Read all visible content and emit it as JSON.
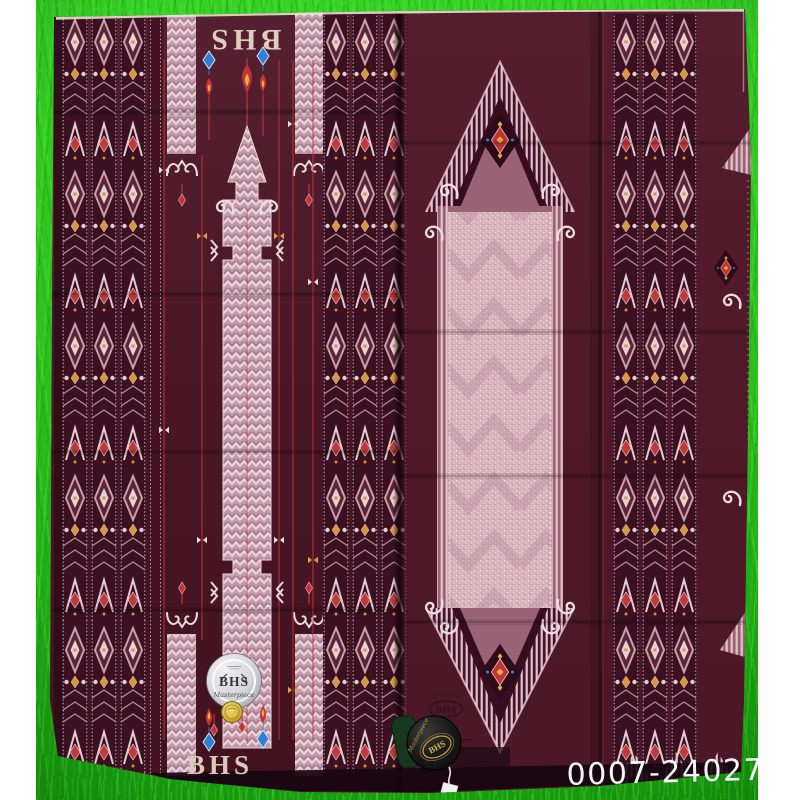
{
  "scene": {
    "watermark": "0007-240271",
    "colors": {
      "background_green": "#2cc01d",
      "margin_white": "#ffffff",
      "fabric_maroon": "#4a1626",
      "pattern_pink": "#c49bab",
      "pattern_light_pink": "#d8b2bd",
      "accent_gold": "#d79043",
      "accent_red": "#c23434",
      "accent_blue": "#2f7fd4",
      "selvage_cream": "#efe3d6"
    }
  },
  "fabric": {
    "brand_top": "BHS",
    "brand_bottom": "BHS"
  },
  "labels": {
    "silver_badge": {
      "brand": "BHS",
      "script": "Masterpiece"
    },
    "fabric_stamp": {
      "brand": "BHS"
    },
    "hang_tag": {
      "brand": "BHS",
      "script": "Masterpiece"
    }
  }
}
